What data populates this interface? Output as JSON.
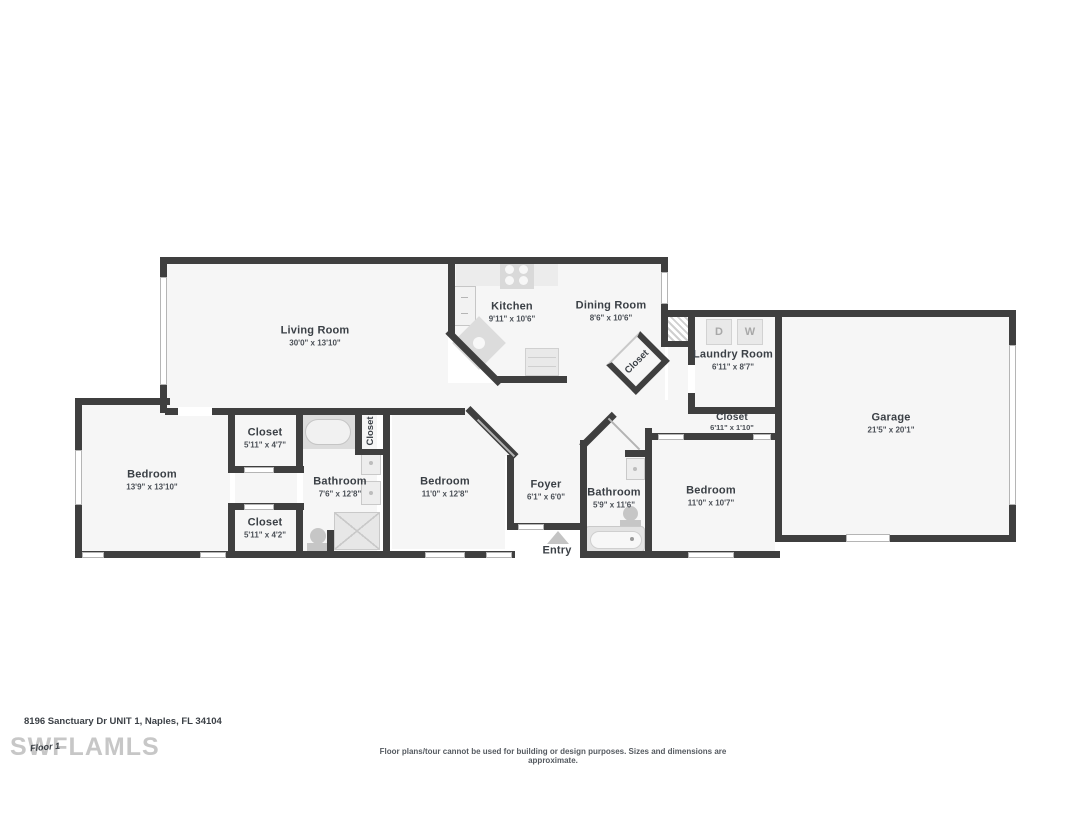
{
  "page": {
    "address": "8196 Sanctuary Dr UNIT 1, Naples, FL 34104",
    "watermark": "SWFLAMLS",
    "floor_label": "Floor 1",
    "disclaimer": "Floor plans/tour cannot be used for building or design purposes. Sizes and dimensions are approximate."
  },
  "colors": {
    "wall": "#3f3f3f",
    "floor": "#f6f6f6",
    "fixture": "#e7e7e7",
    "fixture_detail": "#c9c9c9",
    "text": "#3b4046",
    "watermark": "#c7c7c7"
  },
  "rooms": [
    {
      "name": "Living Room",
      "dims": "30'0\" x 13'10\""
    },
    {
      "name": "Kitchen",
      "dims": "9'11\" x 10'6\""
    },
    {
      "name": "Dining Room",
      "dims": "8'6\" x 10'6\""
    },
    {
      "name": "Laundry Room",
      "dims": "6'11\" x 8'7\""
    },
    {
      "name": "Garage",
      "dims": "21'5\" x 20'1\""
    },
    {
      "name": "Bedroom",
      "dims": "13'9\" x 13'10\""
    },
    {
      "name": "Closet",
      "dims": "5'11\" x 4'7\""
    },
    {
      "name": "Closet",
      "dims": "5'11\" x 4'2\""
    },
    {
      "name": "Bathroom",
      "dims": "7'6\" x 12'8\""
    },
    {
      "name": "Bedroom",
      "dims": "11'0\" x 12'8\""
    },
    {
      "name": "Foyer",
      "dims": "6'1\" x 6'0\""
    },
    {
      "name": "Bathroom",
      "dims": "5'9\" x 11'6\""
    },
    {
      "name": "Bedroom",
      "dims": "11'0\" x 10'7\""
    },
    {
      "name": "Closet",
      "dims": "6'11\" x 1'10\""
    }
  ],
  "labels": {
    "closet_vertical": "Closet",
    "closet_rotated": "Closet",
    "entry": "Entry",
    "dryer": "D",
    "washer": "W"
  }
}
